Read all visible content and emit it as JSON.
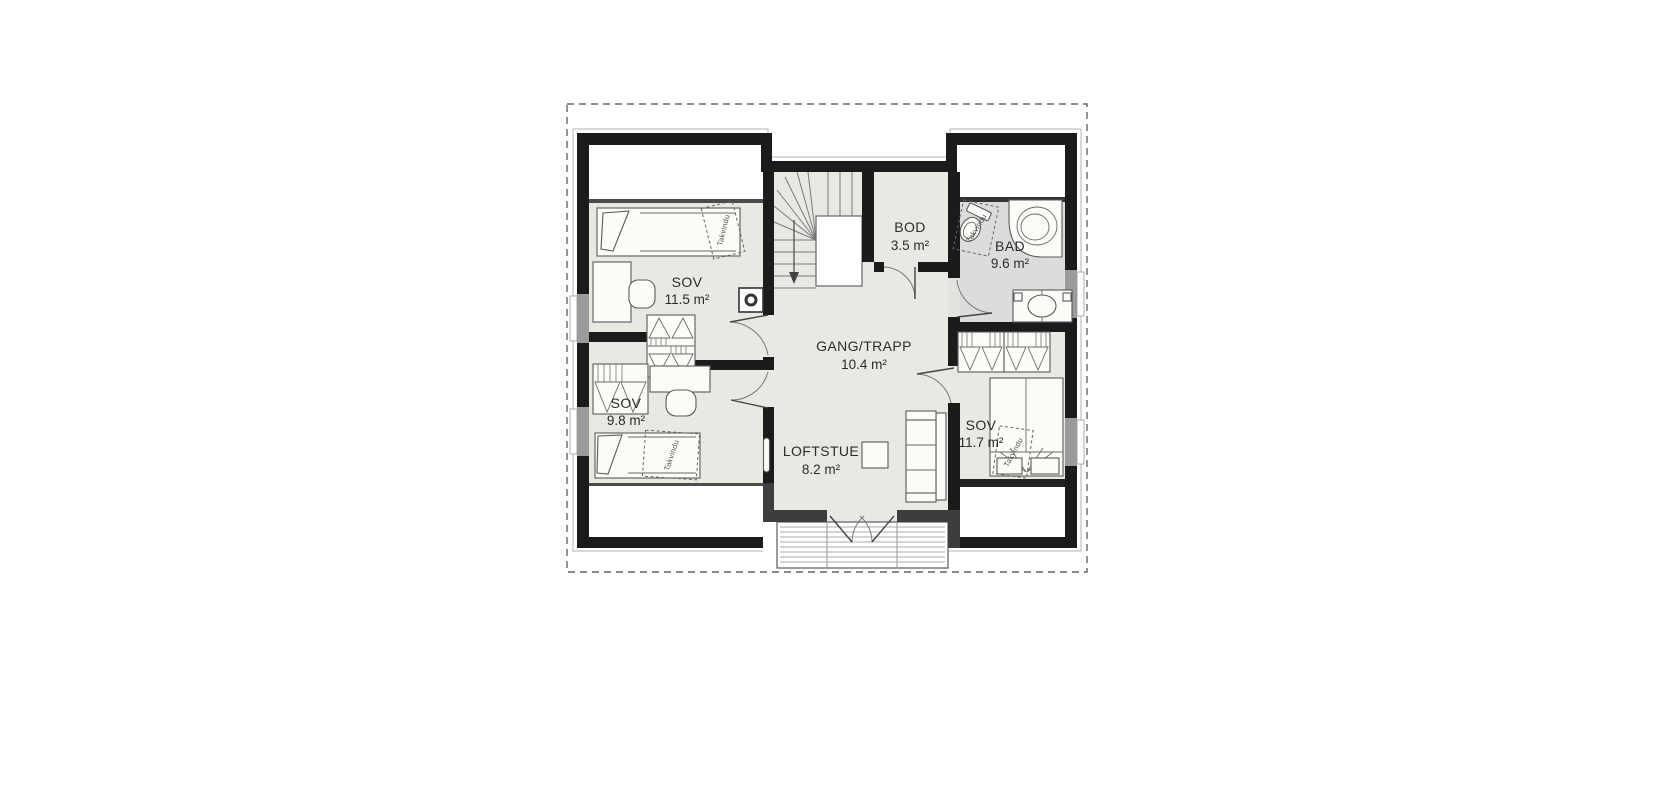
{
  "page": {
    "background": "#ffffff"
  },
  "plan": {
    "type": "floor-plan-loft-storey",
    "language": "Norwegian",
    "rooms": [
      {
        "id": "sov-1",
        "name": "SOV",
        "area": "11.5 m²"
      },
      {
        "id": "sov-2",
        "name": "SOV",
        "area": "9.8 m²"
      },
      {
        "id": "gang-trapp",
        "name": "GANG/TRAPP",
        "area": "10.4 m²"
      },
      {
        "id": "loftstue",
        "name": "LOFTSTUE",
        "area": "8.2 m²"
      },
      {
        "id": "bod",
        "name": "BOD",
        "area": "3.5 m²"
      },
      {
        "id": "bad",
        "name": "BAD",
        "area": "9.6 m²"
      },
      {
        "id": "sov-3",
        "name": "SOV",
        "area": "11.7 m²"
      }
    ],
    "skylight_label": "Takvindu",
    "colors": {
      "floor_fill": "#e9e8e2",
      "bath_fill": "#dcdcdc",
      "wall": "#1b1b1b",
      "secondary_wall": "#3d3d3d",
      "window_wall": "#9b9b9b",
      "roof_outline_dash": "#666666",
      "label_text": "#2b2b2b"
    }
  }
}
